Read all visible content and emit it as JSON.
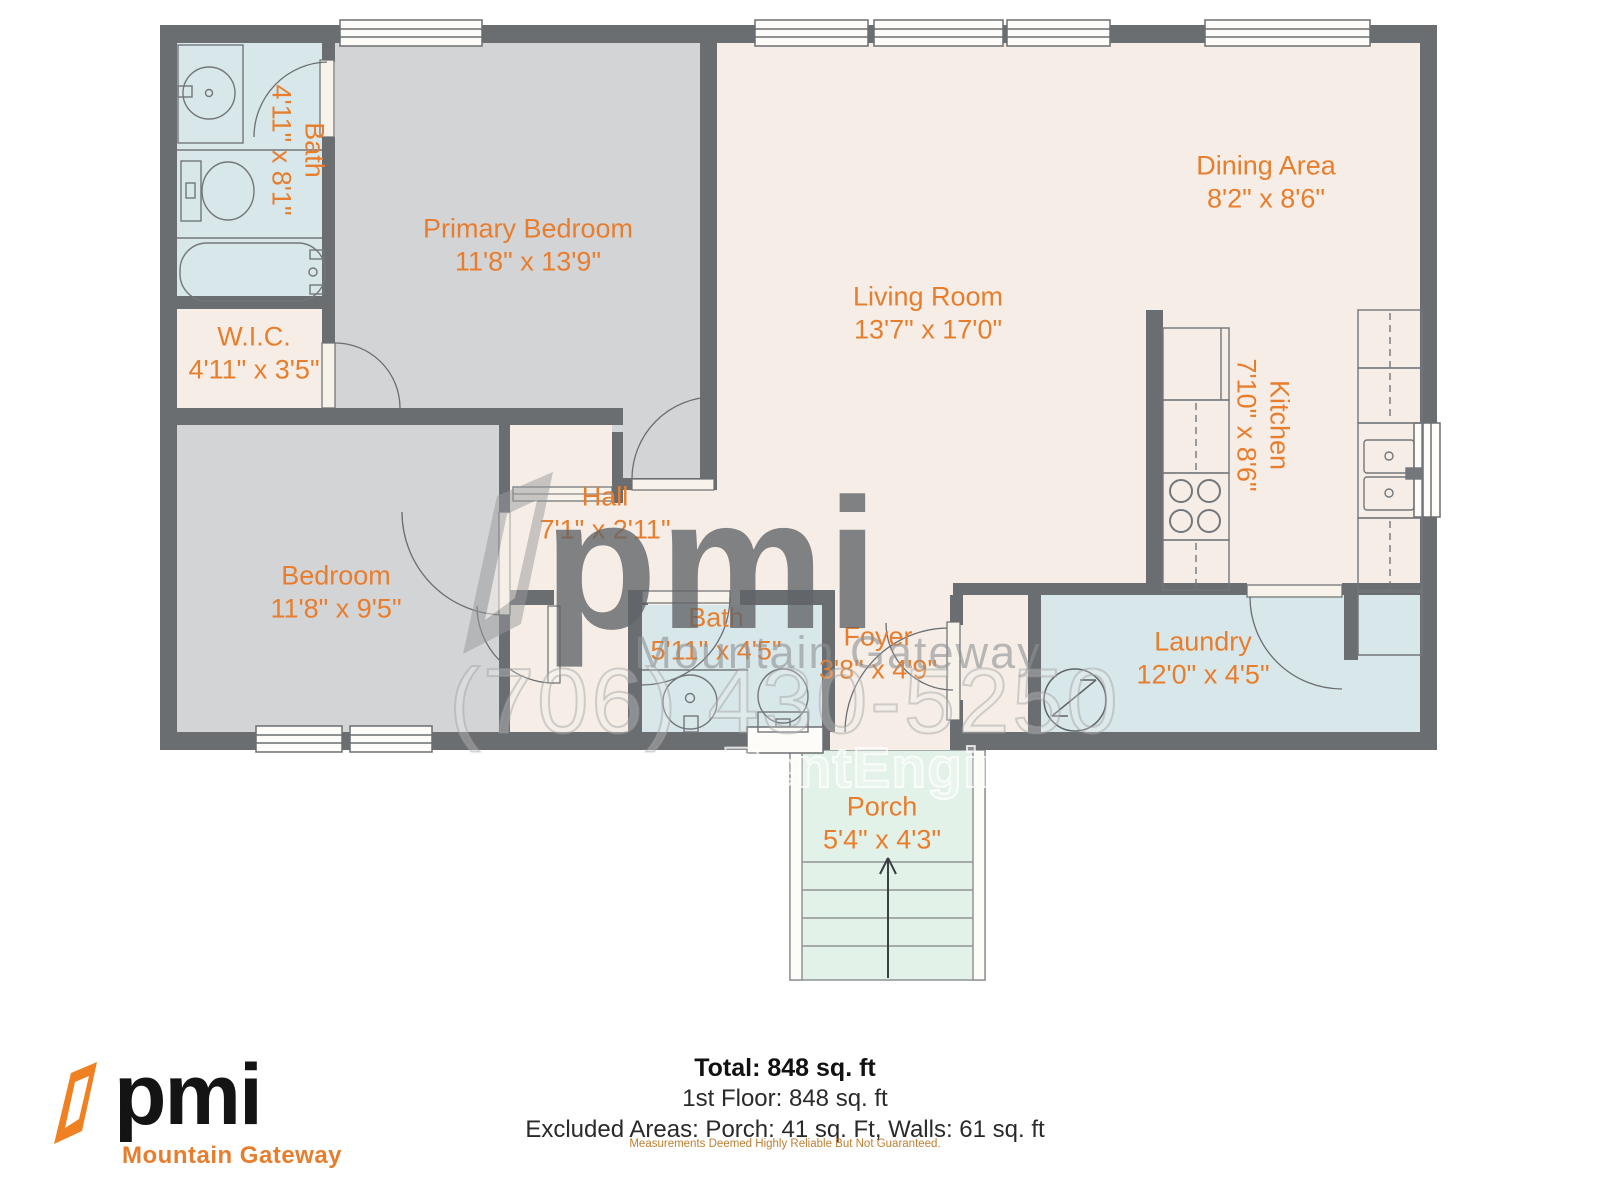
{
  "floorplan": {
    "rooms": [
      {
        "id": "bath-1",
        "label": "Bath",
        "dims": "4'11\" x 8'1\""
      },
      {
        "id": "primary-bedroom",
        "label": "Primary Bedroom",
        "dims": "11'8\" x 13'9\""
      },
      {
        "id": "wic",
        "label": "W.I.C.",
        "dims": "4'11\" x 3'5\""
      },
      {
        "id": "bedroom",
        "label": "Bedroom",
        "dims": "11'8\" x 9'5\""
      },
      {
        "id": "hall",
        "label": "Hall",
        "dims": "7'1\" x 2'11\""
      },
      {
        "id": "bath-2",
        "label": "Bath",
        "dims": "5'11\" x 4'5\""
      },
      {
        "id": "foyer",
        "label": "Foyer",
        "dims": "3'8\" x 4'9\""
      },
      {
        "id": "living-room",
        "label": "Living Room",
        "dims": "13'7\" x 17'0\""
      },
      {
        "id": "dining-area",
        "label": "Dining Area",
        "dims": "8'2\" x 8'6\""
      },
      {
        "id": "kitchen",
        "label": "Kitchen",
        "dims": "7'10\" x 8'6\""
      },
      {
        "id": "laundry",
        "label": "Laundry",
        "dims": "12'0\" x 4'5\""
      },
      {
        "id": "porch",
        "label": "Porch",
        "dims": "5'4\" x 4'3\""
      }
    ],
    "watermark": {
      "brand": "pmi",
      "name": "Mountain Gateway",
      "phone": "(706) 430-5250",
      "engine": "RentEngine"
    }
  },
  "footer": {
    "logo_text": "pmi",
    "logo_subtext": "Mountain Gateway",
    "total": "Total: 848 sq. ft",
    "floor": "1st Floor: 848 sq. ft",
    "excluded": "Excluded Areas: Porch: 41 sq. Ft, Walls: 61 sq. ft",
    "disclaimer": "Measurements Deemed Highly Reliable But Not Guaranteed."
  },
  "colors": {
    "wall": "#6b6e71",
    "floor_cream": "#f6eee6",
    "floor_gray": "#d3d4d6",
    "floor_blue": "#d8e7ea",
    "floor_mint": "#e3f2e8",
    "label_orange": "#e87e2d",
    "brand_orange": "#f08122"
  }
}
